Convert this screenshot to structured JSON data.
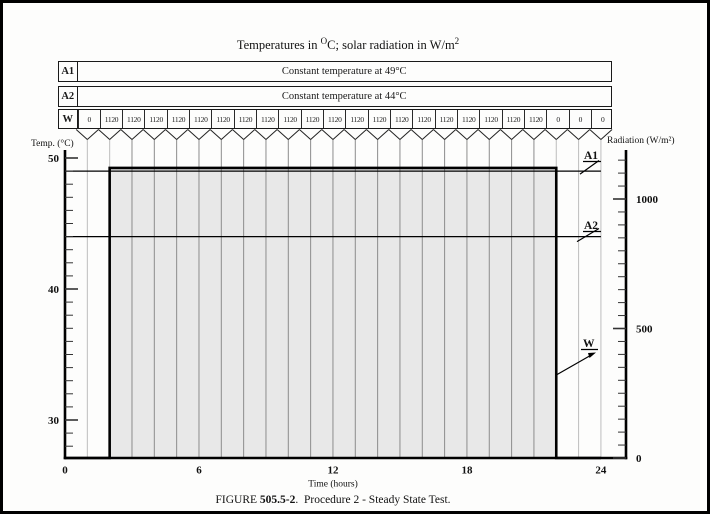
{
  "page": {
    "title_parts": {
      "t1": "Temperatures in ",
      "sup1": "O",
      "t2": "C; solar radiation in W/m",
      "sup2": "2"
    },
    "caption_parts": {
      "p1": "FIGURE ",
      "num": "505.5-2",
      "p2": ".  ",
      "p3": "Procedure 2 - Steady State Test."
    }
  },
  "table": {
    "rows": [
      {
        "label": "A1",
        "value": "Constant temperature at 49°C"
      },
      {
        "label": "A2",
        "value": "Constant temperature at 44°C"
      }
    ],
    "w_row": {
      "label": "W",
      "values": [
        "0",
        "1120",
        "1120",
        "1120",
        "1120",
        "1120",
        "1120",
        "1120",
        "1120",
        "1120",
        "1120",
        "1120",
        "1120",
        "1120",
        "1120",
        "1120",
        "1120",
        "1120",
        "1120",
        "1120",
        "1120",
        "0",
        "0",
        "0"
      ]
    }
  },
  "chart_data": {
    "type": "line",
    "title": "Procedure 2 - Steady State Test",
    "x_axis": {
      "label": "Time (hours)",
      "ticks": [
        0,
        6,
        12,
        18,
        24
      ],
      "range": [
        0,
        24
      ],
      "gridlines_every_hour": true
    },
    "y_left_axis": {
      "label": "Temp. (°C)",
      "major_ticks": [
        30,
        40,
        50
      ],
      "minor_step": 1,
      "minor_range": [
        28,
        50
      ]
    },
    "y_right_axis": {
      "label": "Radiation (W/m²)",
      "major_ticks": [
        0,
        500,
        1000
      ],
      "minor_step": 50,
      "minor_range": [
        0,
        1150
      ]
    },
    "series": [
      {
        "name": "A1",
        "label": "A1",
        "kind": "constant-temperature",
        "value_c": 49,
        "x_span_hours": [
          0,
          24
        ]
      },
      {
        "name": "A2",
        "label": "A2",
        "kind": "constant-temperature",
        "value_c": 44,
        "x_span_hours": [
          0,
          24
        ]
      },
      {
        "name": "W",
        "label": "W",
        "kind": "solar-radiation-step",
        "peak_wm2": 1120,
        "plotted_step_points": [
          [
            0,
            0
          ],
          [
            2,
            0
          ],
          [
            2,
            1120
          ],
          [
            22,
            1120
          ],
          [
            22,
            0
          ],
          [
            24,
            0
          ]
        ],
        "hourly_values_wm2": [
          0,
          1120,
          1120,
          1120,
          1120,
          1120,
          1120,
          1120,
          1120,
          1120,
          1120,
          1120,
          1120,
          1120,
          1120,
          1120,
          1120,
          1120,
          1120,
          1120,
          1120,
          0,
          0,
          0
        ]
      }
    ],
    "shading": {
      "from_hour": 2,
      "to_hour": 22,
      "top_wm2": 1120,
      "fill": "#e8e8e8"
    },
    "legend_position": "labels-on-plot-right"
  },
  "colors": {
    "ink": "#111111",
    "heavy_line": "#000000",
    "thin_line": "#1a1a1a",
    "grid_dark": "#8c8c8c",
    "grid_light": "#bdbdbd",
    "shade": "#e8e8e8",
    "page_bg": "#fdfdfc",
    "frame": "#000000"
  }
}
